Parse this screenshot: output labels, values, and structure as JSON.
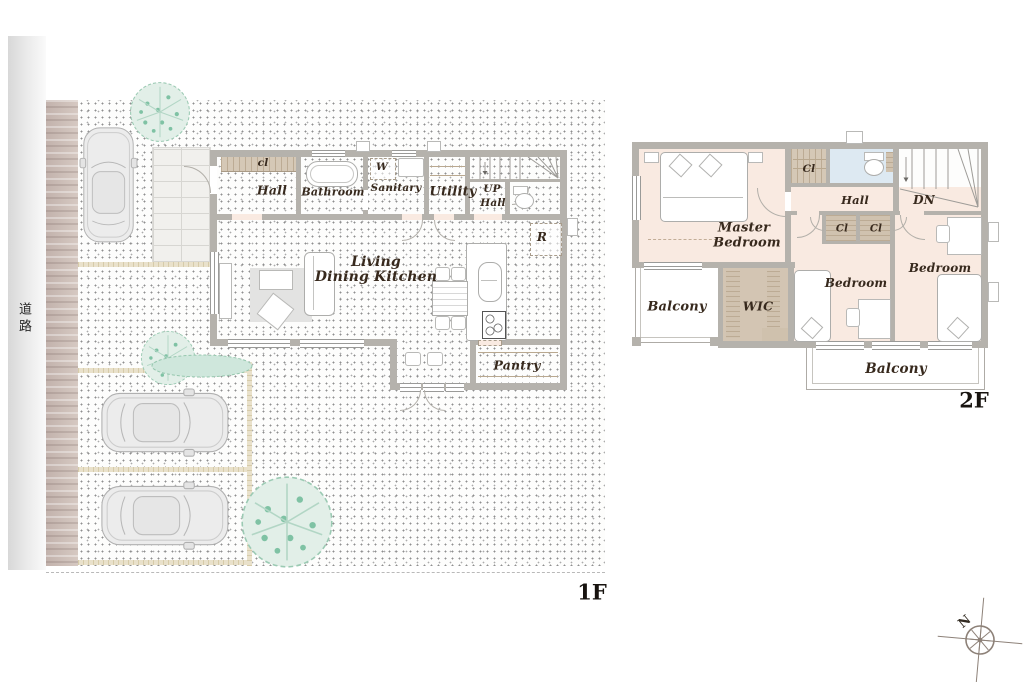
{
  "floors": {
    "f1": {
      "floor_label": "1F",
      "road_label": "道路",
      "rooms": {
        "closet": "cl",
        "hall": "Hall",
        "bathroom": "Bathroom",
        "washer": "W",
        "sanitary": "Sanitary",
        "utility": "Utility",
        "stairs_up": "UP",
        "stairs_up_hall": "Hall",
        "refrigerator": "R",
        "ldk_line1": "Living",
        "ldk_line2": "Dining Kitchen",
        "pantry": "Pantry"
      }
    },
    "f2": {
      "floor_label": "2F",
      "rooms": {
        "master_line1": "Master",
        "master_line2": "Bedroom",
        "closet_top": "Cl",
        "hall": "Hall",
        "stairs_down": "DN",
        "closet_a": "Cl",
        "closet_b": "Cl",
        "bedroom_mid": "Bedroom",
        "bedroom_right": "Bedroom",
        "wic": "WIC",
        "balcony_left": "Balcony",
        "balcony_bottom": "Balcony"
      }
    }
  },
  "compass": {
    "north_label": "N"
  },
  "colors": {
    "wall": "#b5b2ac",
    "room": "#f9eae1",
    "wet_area": "#dde9f2",
    "storage": "#d3c5b3",
    "lawn": "#edf1d8",
    "accent_pink": "#f8d9e0",
    "tree": "#7fc2a4"
  }
}
